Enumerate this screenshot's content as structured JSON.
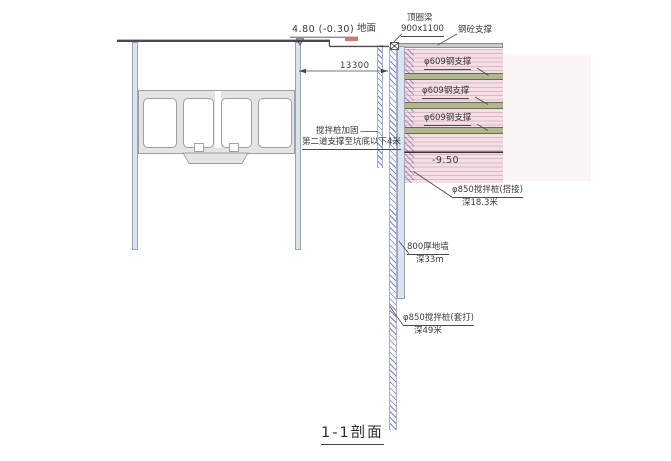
{
  "drawing": {
    "section_title": "1-1剖面",
    "ground": {
      "elevation_label": "4.80 (-0.30)",
      "surface_label": "地面"
    },
    "ring_beam": {
      "name": "顶圈梁",
      "size": "900x1100"
    },
    "concrete_support_label": "钢砼支撑",
    "span_dimension": "13300",
    "steel_supports": [
      "φ609钢支撑",
      "φ609钢支撑",
      "φ609钢支撑"
    ],
    "pit_bottom_level": "-9.50",
    "reinforcement_note": {
      "line1": "搅拌桩加固",
      "line2": "第二道支撑至坑底以下4米"
    },
    "lap_pile": {
      "name": "φ850搅拌桩(搭接)",
      "depth": "深18.3米"
    },
    "diaphragm_wall": {
      "name": "800厚地墙",
      "depth": "深33m"
    },
    "sleeve_pile": {
      "name": "φ850搅拌桩(套打)",
      "depth": "深49米"
    }
  },
  "colors": {
    "wall_blue": "#d9e4f0",
    "soil_pink": "#f4dfe5",
    "support_green": "#b0b68d",
    "beam_gray": "#cbcbcb",
    "structure_gray": "#e4e4e4",
    "level_red": "#dd7272"
  }
}
